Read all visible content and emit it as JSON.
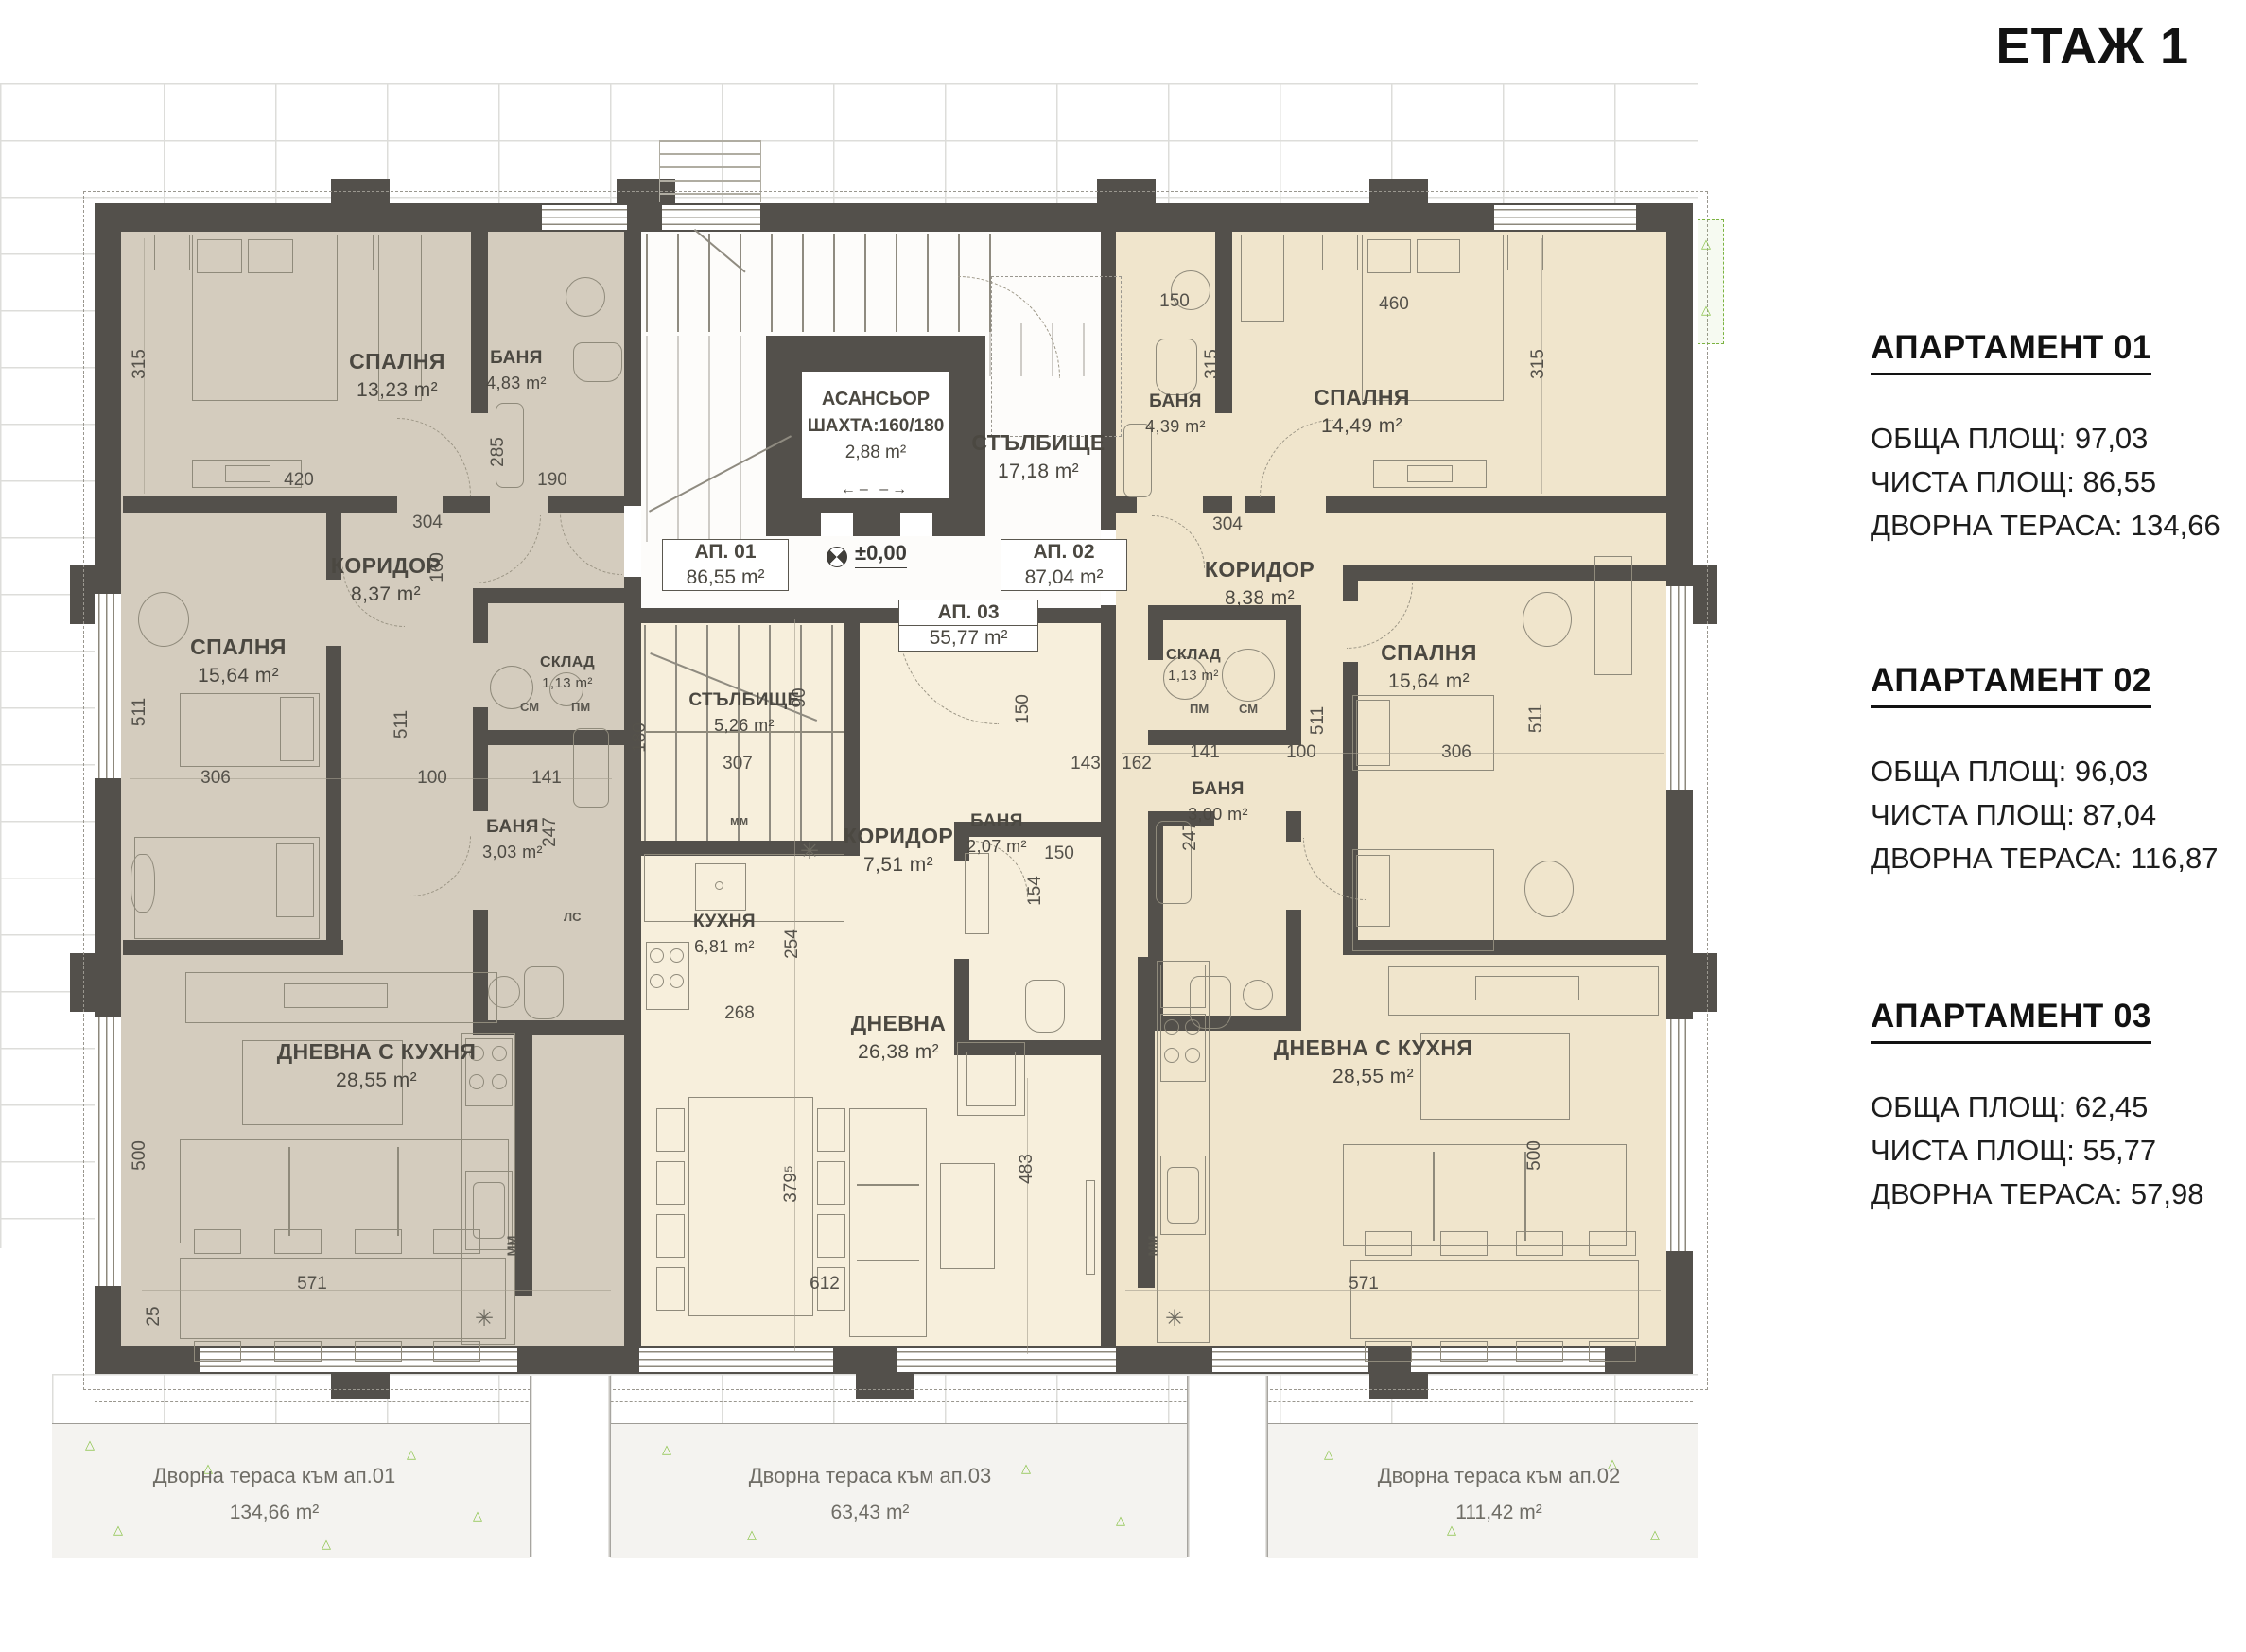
{
  "header": {
    "title": "ЕТАЖ 1"
  },
  "panel": {
    "apartments": [
      {
        "heading": "АПАРТАМЕНТ 01",
        "total": "ОБЩА ПЛОЩ: 97,03",
        "net": "ЧИСТА ПЛОЩ: 86,55",
        "terrace": "ДВОРНА ТЕРАСА: 134,66"
      },
      {
        "heading": "АПАРТАМЕНТ 02",
        "total": "ОБЩА ПЛОЩ: 96,03",
        "net": "ЧИСТА ПЛОЩ: 87,04",
        "terrace": "ДВОРНА ТЕРАСА: 116,87"
      },
      {
        "heading": "АПАРТАМЕНТ 03",
        "total": "ОБЩА ПЛОЩ: 62,45",
        "net": "ЧИСТА ПЛОЩ: 55,77",
        "terrace": "ДВОРНА ТЕРАСА: 57,98"
      }
    ]
  },
  "plan": {
    "rooms": {
      "ap1_bed1": {
        "name": "СПАЛНЯ",
        "area": "13,23 m²"
      },
      "ap1_bath1": {
        "name": "БАНЯ",
        "area": "4,83 m²"
      },
      "ap1_corr": {
        "name": "КОРИДОР",
        "area": "8,37 m²"
      },
      "ap1_bed2": {
        "name": "СПАЛНЯ",
        "area": "15,64 m²"
      },
      "ap1_store": {
        "name": "СКЛАД",
        "area": "1,13 m²"
      },
      "ap1_bath2": {
        "name": "БАНЯ",
        "area": "3,03 m²"
      },
      "ap1_living": {
        "name": "ДНЕВНА С КУХНЯ",
        "area": "28,55 m²"
      },
      "core_stairs": {
        "name": "СТЪЛБИЩЕ",
        "area": "17,18 m²"
      },
      "ap3_stairs": {
        "name": "СТЪЛБИЩЕ",
        "area": "5,26 m²"
      },
      "ap3_kitchen": {
        "name": "КУХНЯ",
        "area": "6,81 m²"
      },
      "ap3_corr": {
        "name": "КОРИДОР",
        "area": "7,51 m²"
      },
      "ap3_bath": {
        "name": "БАНЯ",
        "area": "2,07 m²"
      },
      "ap3_living": {
        "name": "ДНЕВНА",
        "area": "26,38 m²"
      },
      "ap2_bath1": {
        "name": "БАНЯ",
        "area": "4,39 m²"
      },
      "ap2_bed1": {
        "name": "СПАЛНЯ",
        "area": "14,49 m²"
      },
      "ap2_corr": {
        "name": "КОРИДОР",
        "area": "8,38 m²"
      },
      "ap2_store": {
        "name": "СКЛАД",
        "area": "1,13 m²"
      },
      "ap2_bath2": {
        "name": "БАНЯ",
        "area": "3,00 m²"
      },
      "ap2_bed2": {
        "name": "СПАЛНЯ",
        "area": "15,64 m²"
      },
      "ap2_living": {
        "name": "ДНЕВНА С КУХНЯ",
        "area": "28,55 m²"
      }
    },
    "elevator": {
      "l1": "АСАНСЬОР",
      "l2": "ШАХТА:160/180",
      "l3": "2,88 m²",
      "arrows": "←–    –→"
    },
    "level": "±0,00",
    "units": {
      "ap1c": "АП. 01",
      "ap1a": "86,55 m²",
      "ap2c": "АП. 02",
      "ap2a": "87,04 m²",
      "ap3c": "АП. 03",
      "ap3a": "55,77 m²"
    },
    "tags": {
      "sm": "СМ",
      "pm": "ПМ",
      "ls": "ЛС",
      "mm": "ММ",
      "mml": "мм"
    },
    "dims": {
      "l315": "315",
      "l420": "420",
      "l190": "190",
      "l285": "285",
      "l304": "304",
      "l160": "160",
      "l511a": "511",
      "l511b": "511",
      "l306": "306",
      "l100": "100",
      "l141": "141",
      "l247": "247",
      "l180": "180",
      "l500": "500",
      "l571": "571",
      "l25": "25",
      "c307": "307",
      "c90": "90",
      "c143": "143",
      "c162": "162",
      "c150a": "150",
      "c150b": "150",
      "c154": "154",
      "c254": "254",
      "c268": "268",
      "c3795": "379⁵",
      "c612": "612",
      "c483": "483",
      "r150": "150",
      "r460": "460",
      "r315a": "315",
      "r315b": "315",
      "r304": "304",
      "r141": "141",
      "r100": "100",
      "r306": "306",
      "r511a": "511",
      "r511b": "511",
      "r247": "247",
      "r500": "500",
      "r571": "571"
    },
    "terraces": [
      {
        "label": "Дворна тераса към ап.01",
        "area": "134,66 m²"
      },
      {
        "label": "Дворна тераса към ап.03",
        "area": "63,43 m²"
      },
      {
        "label": "Дворна тераса към ап.02",
        "area": "111,42 m²"
      }
    ]
  }
}
